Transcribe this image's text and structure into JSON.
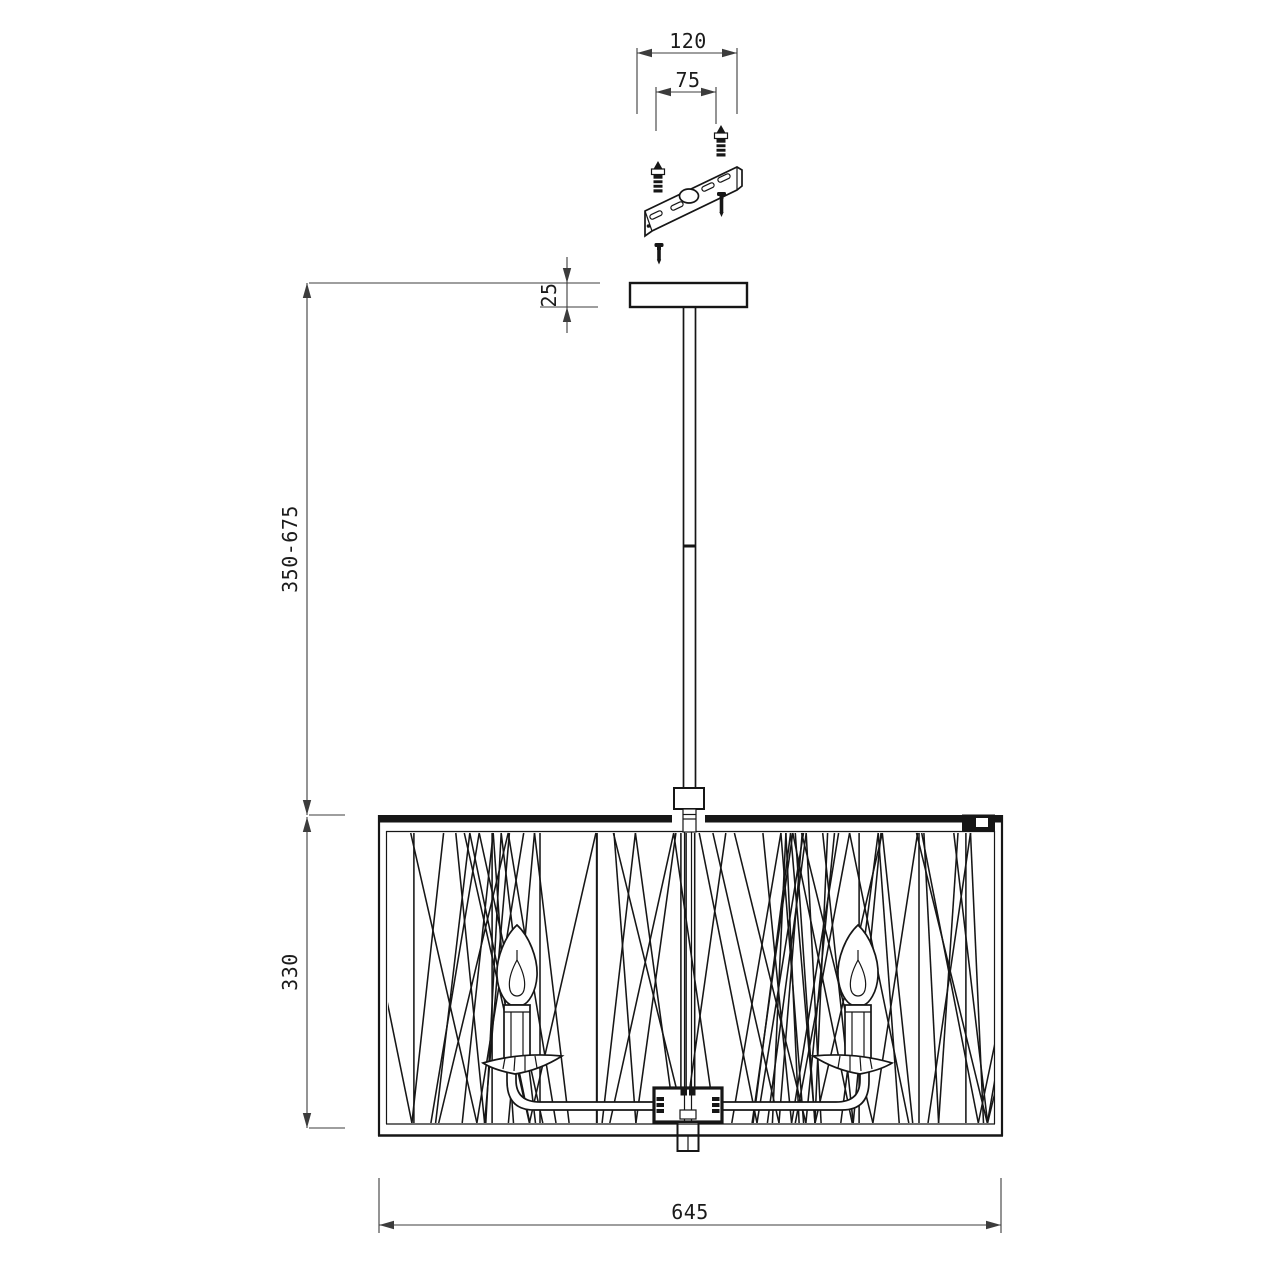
{
  "drawing": {
    "dim_bracket_width": "120",
    "dim_anchor_spacing": "75",
    "dim_canopy_height": "25",
    "dim_rod_range": "350-675",
    "dim_shade_height": "330",
    "dim_shade_width": "645"
  },
  "colors": {
    "line": "#161616",
    "dim_line": "#3c3c3c",
    "background": "#ffffff"
  }
}
